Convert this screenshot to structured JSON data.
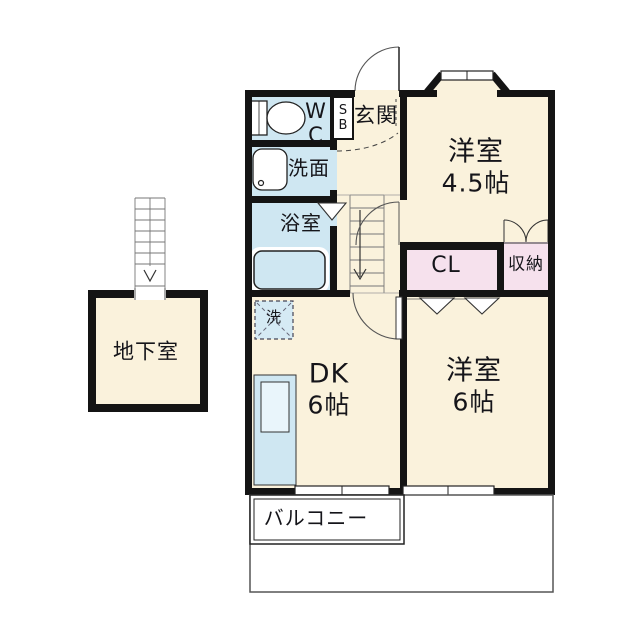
{
  "floorplan": {
    "rooms": {
      "wc": {
        "label": "WC"
      },
      "shoebox": {
        "label": "SB"
      },
      "entrance": {
        "label": "玄関"
      },
      "washroom": {
        "label": "洗面"
      },
      "bathroom": {
        "label": "浴室"
      },
      "western_room_45": {
        "label": "洋室",
        "size": "4.5帖"
      },
      "closet": {
        "label": "CL"
      },
      "storage": {
        "label": "収納"
      },
      "dining_kitchen": {
        "label": "DK",
        "size": "6帖"
      },
      "western_room_6": {
        "label": "洋室",
        "size": "6帖"
      },
      "basement": {
        "label": "地下室"
      },
      "balcony": {
        "label": "バルコニー"
      },
      "laundry_space": {
        "label": "洗"
      }
    },
    "colors": {
      "wall": "#141414",
      "room_cream": "#FAF2DC",
      "wet_area_blue": "#CFE7F2",
      "closet_pink": "#F6E1ED",
      "fixture_blue_light": "#E9F5FB",
      "background": "#FFFFFF"
    }
  }
}
